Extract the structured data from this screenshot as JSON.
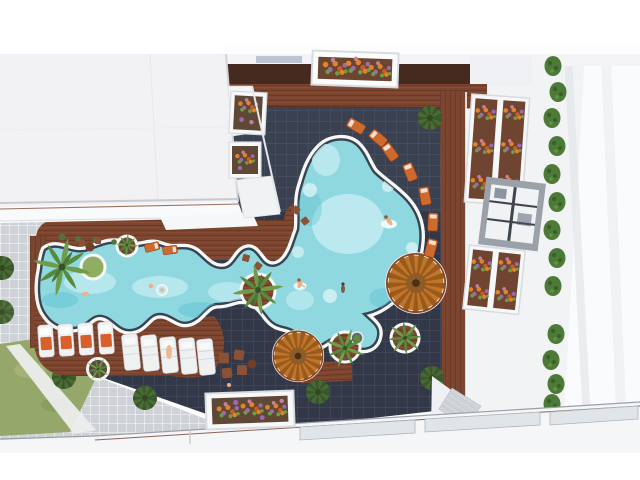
{
  "scene": {
    "title": "Aerial 3D render of a resort pool courtyard",
    "description": "Top-down architectural rendering: a freeform lazy-river pool joins a large round pool inside a dark-tiled courtyard framed by white apartment buildings, wooden decks, sun loungers, round wooden umbrella platforms, palm trees, flower planters, hedges and a grass lawn.",
    "colors": {
      "background": "#ffffff",
      "roof_white": "#f2f2f4",
      "building_white": "#f2f3f5",
      "tile_dark": "#323848",
      "tile_grout": "#6b7386",
      "plaza_tile": "#ced2d6",
      "wood_deck": "#7c452f",
      "pool_water": "#8fd8e0",
      "pool_water_light": "#c6eef2",
      "pool_rim": "#f7f8f8",
      "pool_ring": "#3a4352",
      "grass": "#95a76a",
      "bush_green": "#4a6b35",
      "palm_green": "#6f9c49",
      "hedge_green": "#4e7a38",
      "lounger_orange": "#d95f2d",
      "umbrella_orange": "#c07629",
      "flower_orange": "#e0832c",
      "flower_purple": "#9a6ab0",
      "skin": "#eab28a"
    },
    "features": [
      "freeform-lazy-river-pool",
      "round-main-pool",
      "sun-lounger-rows",
      "radial-poolside-loungers",
      "palm-trees",
      "round-wooden-umbrella-decks",
      "flower-planters",
      "hedge-row",
      "grass-lawn",
      "dark-tiled-courtyard",
      "light-tiled-plaza",
      "white-apartment-roofs",
      "stairs",
      "swimmers"
    ],
    "counts": {
      "sun_loungers_left_row": 4,
      "sun_loungers_center_row": 5,
      "radial_loungers": 7,
      "palm_trees": 6,
      "umbrella_decks": 2,
      "people_in_water": 6
    }
  }
}
